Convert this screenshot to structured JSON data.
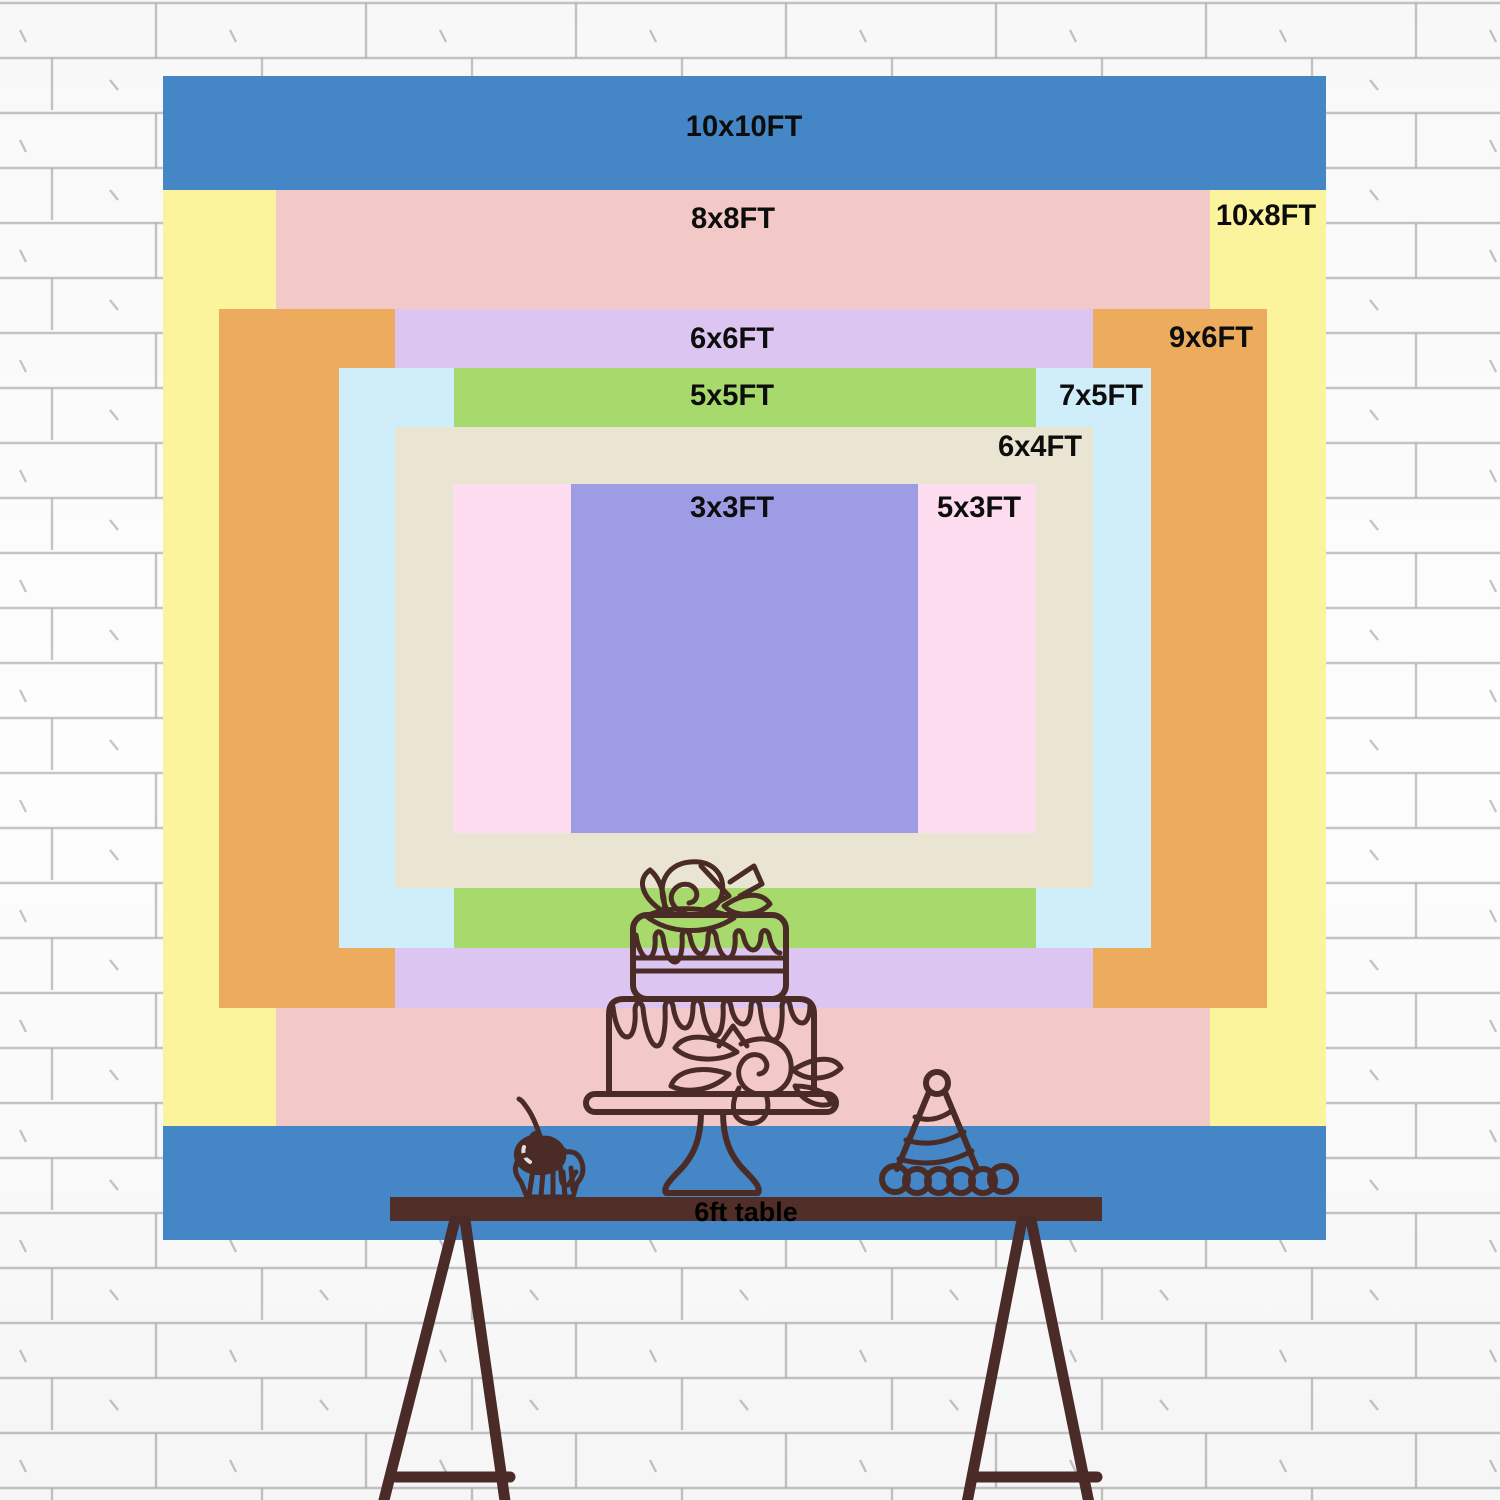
{
  "title": "Backdrop size comparison chart",
  "colors": {
    "ink": "#4a2b26",
    "table": "#512f28",
    "table_label": "#000000",
    "legs": "#4b2b28",
    "label": "#0d0d0d",
    "wall": "#fdfdfd",
    "brick_line": "#b3b3b3"
  },
  "sizes": [
    {
      "label": "10x10FT",
      "color": "#4486c6",
      "rect": {
        "x": 163,
        "y": 76,
        "w": 1163,
        "h": 1164
      },
      "label_pos": {
        "x": 744,
        "y": 127
      }
    },
    {
      "label": "10x8FT",
      "color": "#fbf49d",
      "rect": {
        "x": 163,
        "y": 190,
        "w": 1163,
        "h": 936
      },
      "label_pos": {
        "x": 1266,
        "y": 216
      }
    },
    {
      "label": "8x8FT",
      "color": "#f3c9c8",
      "rect": {
        "x": 276,
        "y": 190,
        "w": 934,
        "h": 936
      },
      "label_pos": {
        "x": 733,
        "y": 219
      }
    },
    {
      "label": "9x6FT",
      "color": "#ecab5d",
      "rect": {
        "x": 219,
        "y": 309,
        "w": 1048,
        "h": 699
      },
      "label_pos": {
        "x": 1211,
        "y": 338
      }
    },
    {
      "label": "6x6FT",
      "color": "#dcc5f0",
      "rect": {
        "x": 395,
        "y": 309,
        "w": 698,
        "h": 699
      },
      "label_pos": {
        "x": 732,
        "y": 339
      }
    },
    {
      "label": "7x5FT",
      "color": "#cfeefa",
      "rect": {
        "x": 339,
        "y": 368,
        "w": 812,
        "h": 580
      },
      "label_pos": {
        "x": 1101,
        "y": 396
      }
    },
    {
      "label": "5x5FT",
      "color": "#a8d96d",
      "rect": {
        "x": 454,
        "y": 368,
        "w": 582,
        "h": 580
      },
      "label_pos": {
        "x": 732,
        "y": 396
      }
    },
    {
      "label": "6x4FT",
      "color": "#eae5d3",
      "rect": {
        "x": 395,
        "y": 427,
        "w": 698,
        "h": 461
      },
      "label_pos": {
        "x": 1040,
        "y": 447
      }
    },
    {
      "label": "5x3FT",
      "color": "#fcdcee",
      "rect": {
        "x": 453,
        "y": 484,
        "w": 583,
        "h": 349
      },
      "label_pos": {
        "x": 979,
        "y": 508
      }
    },
    {
      "label": "3x3FT",
      "color": "#9d9ce4",
      "rect": {
        "x": 571,
        "y": 484,
        "w": 347,
        "h": 349
      },
      "label_pos": {
        "x": 732,
        "y": 508
      }
    }
  ],
  "table": {
    "label": "6ft table",
    "color": "#512f28",
    "rect": {
      "x": 390,
      "y": 1197,
      "w": 712,
      "h": 24
    }
  },
  "decorations": {
    "wall": "brick-wall-sketch",
    "cake": "two-tier-cake-icon",
    "cupcake": "cupcake-with-cherry-icon",
    "party_hat": "party-hat-icon",
    "stand": "trestle-table-legs"
  }
}
